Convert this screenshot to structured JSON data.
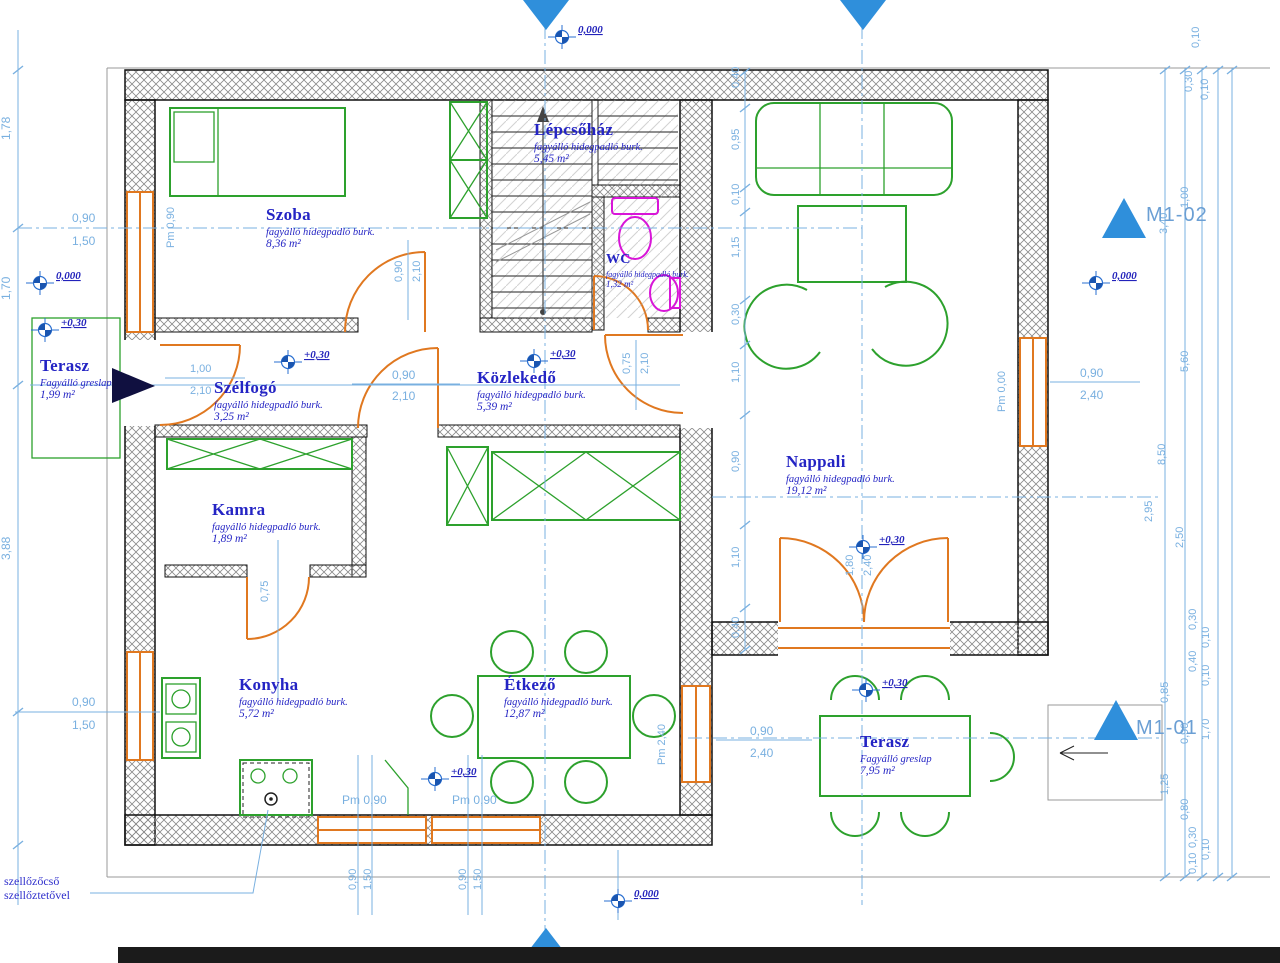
{
  "rooms": [
    {
      "name": "Szoba",
      "desc": "fagyálló hidegpadló burk.",
      "area": "8,36 m²"
    },
    {
      "name": "Lépcsőház",
      "desc": "fagyálló hidegpadló burk.",
      "area": "5,45 m²"
    },
    {
      "name": "WC",
      "desc": "fagyálló hidegpadló burk.",
      "area": "1,32 m²"
    },
    {
      "name": "Terasz",
      "desc": "Fagyálló greslap",
      "area": "1,99 m²"
    },
    {
      "name": "Szélfogó",
      "desc": "fagyálló hidegpadló burk.",
      "area": "3,25 m²"
    },
    {
      "name": "Közlekedő",
      "desc": "fagyálló hidegpadló burk.",
      "area": "5,39 m²"
    },
    {
      "name": "Kamra",
      "desc": "fagyálló hidegpadló burk.",
      "area": "1,89 m²"
    },
    {
      "name": "Nappali",
      "desc": "fagyálló hidegpadló burk.",
      "area": "19,12 m²"
    },
    {
      "name": "Konyha",
      "desc": "fagyálló hidegpadló burk.",
      "area": "5,72 m²"
    },
    {
      "name": "Étkező",
      "desc": "fagyálló hidegpadló burk.",
      "area": "12,87 m²"
    },
    {
      "name": "Terasz",
      "desc": "Fagyálló greslap",
      "area": "7,95 m²"
    }
  ],
  "elevations": {
    "zero": "0,000",
    "plus": "+0,30"
  },
  "markers": {
    "m1_02": "M1-02",
    "m1_01": "M1-01"
  },
  "notes": {
    "vent_line1": "szellőzőcső",
    "vent_line2": "szellőztetővel"
  },
  "dims": {
    "left": [
      "1,78",
      "1,70",
      "3,88"
    ],
    "left_win_top": [
      "0,90",
      "1,50"
    ],
    "left_win_bottom": [
      "0,90",
      "1,50"
    ],
    "entry_door": [
      "1,00",
      "2,10"
    ],
    "szoba_door": [
      "0,90",
      "2,10"
    ],
    "center_door": [
      "0,90",
      "2,10"
    ],
    "kozlekedo_door": [
      "0,75",
      "2,10"
    ],
    "kamra_door": [
      "0,75"
    ],
    "terrace_door": [
      "1,80",
      "2,40"
    ],
    "right_win": [
      "0,90",
      "2,40"
    ],
    "etkezo_win": [
      "0,90",
      "2,40"
    ],
    "bottom_pm": [
      "Pm 0,90",
      "Pm 0,90"
    ],
    "bottom_pairs": [
      "0,90",
      "1,50",
      "0,90",
      "1,50"
    ],
    "pm_labels": [
      "Pm 0,90",
      "Pm 0,00",
      "Pm 2,40"
    ],
    "nappali_chain": [
      "0,40",
      "0,95",
      "0,10",
      "1,15",
      "0,30",
      "1,10",
      "0,90",
      "1,10",
      "0,40"
    ],
    "right_chain": [
      "0,10",
      "0,30",
      "0,10",
      "1,00",
      "3,40",
      "5,60",
      "8,50",
      "2,95",
      "2,50",
      "0,30",
      "0,10",
      "0,40",
      "0,10",
      "0,85",
      "0,90",
      "1,70",
      "1,25",
      "0,80",
      "0,30",
      "0,10",
      "0,10"
    ]
  }
}
